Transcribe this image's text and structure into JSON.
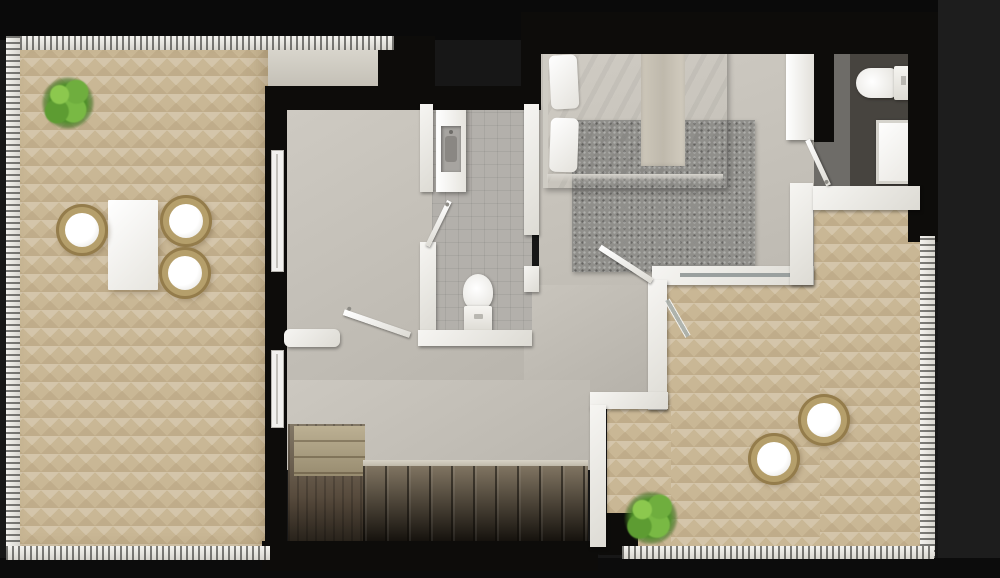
{
  "scene": {
    "title": "3D floor plan render – upper level",
    "style": "top-down architectural visualisation, no text labels",
    "background_color": "#151515"
  },
  "palette": {
    "background": "#151515",
    "wall_black": "#0d0c0a",
    "wall_white": "#f2f1ee",
    "terrace_floor": "#c9b795",
    "hall_floor": "#c2beb6",
    "bathroom_floor": "#b3b0ab",
    "bedroom_floor": "#c8c4bc",
    "ensuite_floor": "#47443f",
    "rug_gray": "#908f8b",
    "stair_wood": "#6e6354",
    "plant_green": "#5d9c32",
    "chair_wicker": "#b59f6b",
    "furniture_white": "#ffffff"
  },
  "rooms": [
    {
      "id": "terrace-left",
      "label": "Left terrace",
      "floor": "herringbone parquet tile",
      "railing": true
    },
    {
      "id": "hallway",
      "label": "Hallway landing",
      "floor": "light screed"
    },
    {
      "id": "bathroom",
      "label": "Bathroom",
      "fixtures": [
        "washbasin vanity",
        "toilet"
      ]
    },
    {
      "id": "bedroom",
      "label": "Bedroom",
      "floor": "light screed"
    },
    {
      "id": "ensuite",
      "label": "En-suite shower room",
      "fixtures": [
        "toilet",
        "shower tray"
      ]
    },
    {
      "id": "terrace-right",
      "label": "Right terrace",
      "floor": "herringbone parquet tile",
      "railing": true
    },
    {
      "id": "staircase",
      "label": "Staircase down"
    }
  ],
  "furniture": {
    "dining_table": {
      "label": "Outdoor dining table",
      "color": "white"
    },
    "chair": {
      "label": "Round wicker chair with white cushion",
      "count_left_terrace": 3,
      "count_right_terrace": 2
    },
    "plant": {
      "label": "Green shrub planter",
      "count": 2
    },
    "bed": {
      "label": "Double bed with white duvet, two pillows and beige throw"
    },
    "rug": {
      "label": "Gray area rug"
    },
    "wardrobe": {
      "label": "White wardrobe"
    },
    "vanity": {
      "label": "Washbasin vanity unit"
    },
    "toilet_main": {
      "label": "Toilet – main bathroom"
    },
    "toilet_ensuite": {
      "label": "Toilet – en-suite"
    },
    "shower": {
      "label": "Shower tray"
    },
    "stairs": {
      "label": "Timber staircase descending"
    },
    "glass_door": {
      "label": "Sliding glass terrace door"
    },
    "interior_door": {
      "label": "Interior swing door",
      "count": 4
    },
    "window": {
      "label": "Window in facade wall",
      "count": 2
    },
    "railing": {
      "label": "White terrace balustrade"
    }
  }
}
